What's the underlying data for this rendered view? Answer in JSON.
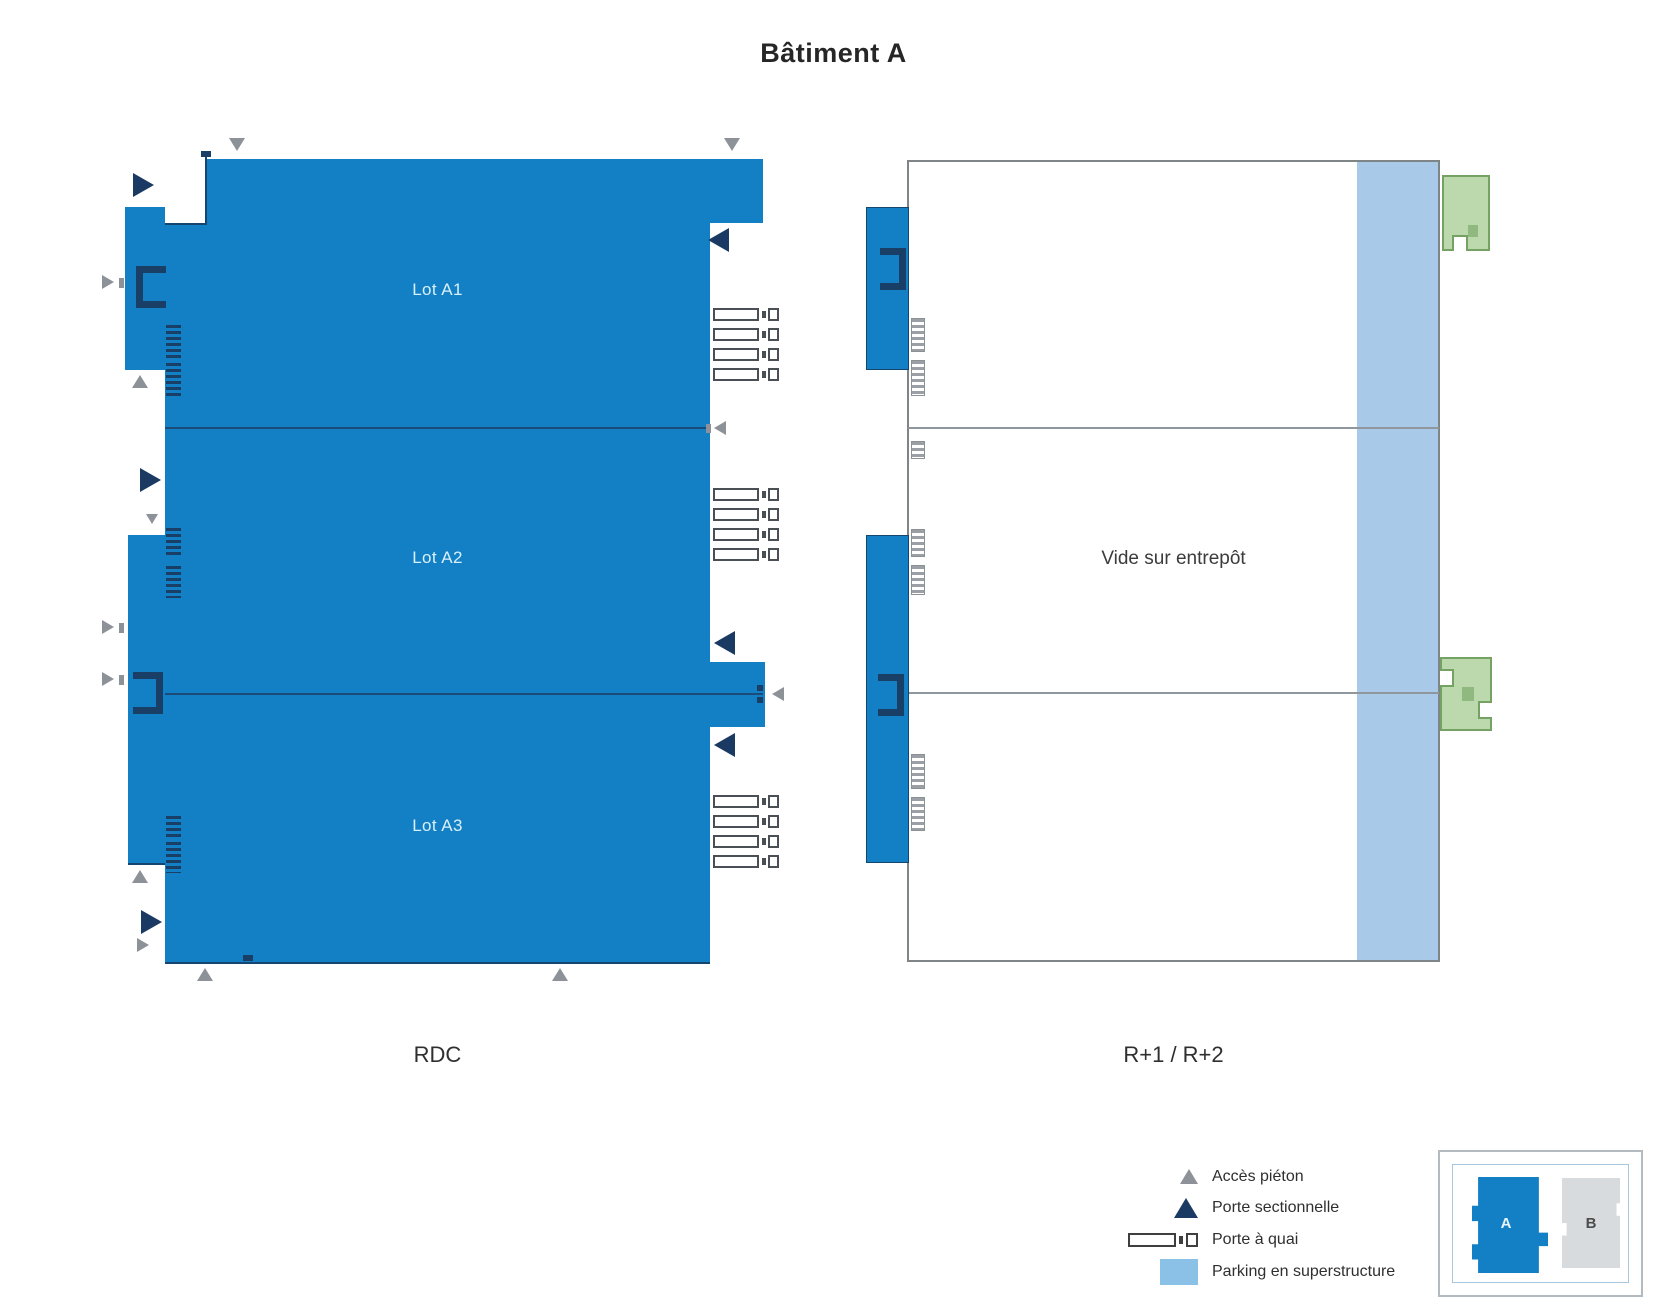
{
  "title": "Bâtiment A",
  "plans": {
    "rdc": {
      "label": "RDC",
      "lots": [
        {
          "label": "Lot A1"
        },
        {
          "label": "Lot A2"
        },
        {
          "label": "Lot A3"
        }
      ]
    },
    "upper": {
      "label": "R+1 / R+2",
      "note": "Vide sur entrepôt"
    }
  },
  "legend": {
    "items": [
      {
        "icon": "pedestrian-access-triangle",
        "label": "Accès piéton"
      },
      {
        "icon": "sectional-door-triangle",
        "label": "Porte sectionnelle"
      },
      {
        "icon": "dock-door",
        "label": "Porte à quai"
      },
      {
        "icon": "superstructure-parking-swatch",
        "label": "Parking en superstructure"
      }
    ]
  },
  "minimap": {
    "buildings": [
      {
        "label": "A",
        "highlighted": true
      },
      {
        "label": "B",
        "highlighted": false
      }
    ]
  },
  "colors": {
    "building_blue": "#1380c5",
    "sectional_navy": "#1a3a64",
    "pedestrian_gray": "#8d9298",
    "parking_blue": "#a9c9e9",
    "exterior_stair_green": "#bcd9ae",
    "outline_gray": "#7f8487"
  }
}
